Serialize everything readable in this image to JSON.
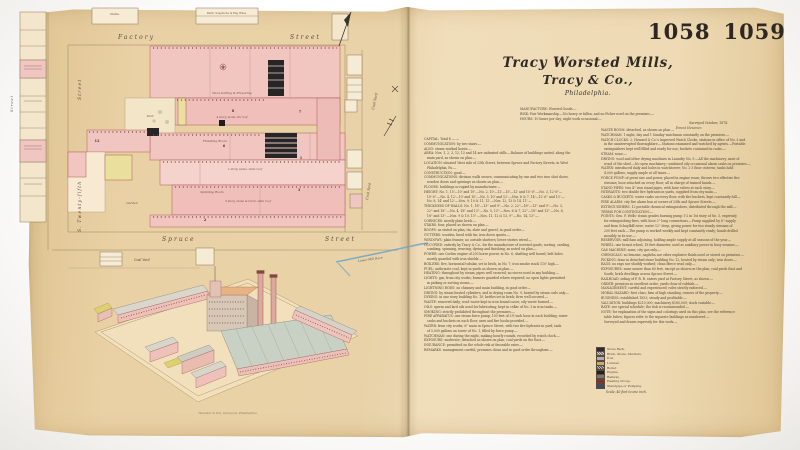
{
  "page": {
    "plate_left": "1058",
    "plate_right": "1059"
  },
  "title": {
    "line1": "Tracy Worsted Mills,",
    "line2": "Tracy & Co.,",
    "line3": "Philadelphia."
  },
  "header": {
    "line1": "MANUFACTURE: Worsted Goods.—",
    "line2": "RISK: Fair Workmanship.—No heavy or fallen, and no Picker used on the premises.—",
    "line3": "HOURS: 10 hours per day; night work occasional.—",
    "surveyed": "Surveyed October, 1874.",
    "signature": "Ernest Hexamer."
  },
  "notes": {
    "col1": [
      "CAPITAL: Total $ —.—",
      "COMMUNICATION: by two stairs.—",
      "ALSO: steam worked hoists.—",
      "AREA: Nos. 1, 2, 3, 12, 13 and 14 are unheated stills.—Balance of buildings united, along the",
      "   main yard, as shown on plan.—",
      "LOCATION: situated West side of 25th Street, between Spruce and Factory Streets, in West",
      "   Philadelphia, Pa.—",
      "CONSTRUCTION: good.—",
      "COMMUNICATIONS: division walls secure, communicating by one and two iron shut doors,",
      "   wooden doors and openings as shown on plan.—",
      "FLOORS: buildings occupied by manufacturer.—",
      "HEIGHT: No. 1, 15'—10' and 10'.—No. 2, 10'—12'—15'—12' and 10' 6''.—No. 3, 12' 6''—",
      "   10' 6''.—No. 4, 12'—10' and 10'.—No. 5, 10' and 12'.—Nos. 6 & 7, 14'—12' 6'' and 13'.—",
      "   No. 8, 14' and 12'.—Nos. 9, 10 & 11, 12'.—Nos. 12, 13 & 14, 11'.—",
      "THICKNESS OF WALLS: No. 1, 18''—13'' and 9''.—No. 2, 22''—18''—13'' and 9''.—No. 3,",
      "   22'' and 18''.—No. 4, 18'' and 13''.—No. 5, 13''.—Nos. 6 & 7, 22''—18'' and 13''.—No. 8,",
      "   18'' and 13''.—Nos. 9 & 10, 13''.—Nos. 11, 12 & 13, 9''.—No. 14, 13''.—",
      "CORNICES: mostly plain brick.—",
      "STAIRS: four, placed as shown on plan.—",
      "ROOFS: as stated on plan; tin, slate and gravel, in good order.—",
      "GUTTERS: wooden, lined with tin; iron down spouts.—",
      "WINDOWS: plain frames; no outside shutters; lower stories wired.—",
      "OCCUPIED: entirely by Tracy & Co., for the manufacture of worsted goods; sorting, carding,",
      "   combing, spinning, weaving, dyeing and finishing, as noted on plan.—",
      "POWER: one Corliss engine of 250 horse power, in No. 6; shafting well boxed; belt holes",
      "   mostly guarded with iron shields.—",
      "BOILERS: five, horizontal tubular, set in brick, in No. 7; iron smoke stack 110' high.—",
      "FUEL: anthracite coal, kept in yards as shown on plan.—",
      "HEATING: throughout by steam; pipes well secured; no stoves used in any building.—",
      "LIGHTS: gas, from city works; burners guarded where required; no open lights permitted",
      "   in picking or sorting rooms.—",
      "LIGHTNING RODS: on chimney and main building, in good order.—",
      "DRYING: by steam heated cylinders, and in drying room No. 9, heated by steam coils only.—",
      "DYEING: in one story building No. 10; kettles set in brick; fires well secured.—",
      "WASTE: removed daily; wool waste kept in iron bound cases; oily waste burned.—",
      "OILS: sperm and lard oils used for lubricating; kept in cellar of No. 3 in iron tanks.—",
      "SMOKING: strictly prohibited throughout the premises.—",
      "FIRE APPARATUS: one steam force pump; 150 feet of 2½ inch hose in each building; water",
      "   casks and buckets on each floor; axes and fire hooks provided.—",
      "WATER: from city works; 6'' main in Spruce Street, with two fire hydrants in yard; tank",
      "   of 5,000 gallons on tower of No. 1, filled by force pump.—",
      "WATCHMAN: one during the night, making hourly rounds, recorded by watch clock.—",
      "EXPOSURE: moderate; detached as shown on plan; coal yards on the East.—",
      "INSURANCE: permitted on the whole risk at favorable rates.—",
      "REMARKS: management careful; premises clean and in good order throughout.—"
    ],
    "col2": [
      "WASTE ROOM: detached, as shown on plan.—",
      "WATCHMAN: 1 night, day and 1 Sunday watchman constantly on the premises.—",
      "WATCH CLOCKS: 2, Howard & Co.'s Improved Watch Clocks; stations in office of No. 3 and",
      "   in the uninterrupted thoroughfare.—Stations examined and watched by agents.—Portable",
      "   extinguishers kept well filled and ready for use; buckets contained in racks.—",
      "STEAM: none.—",
      "DRYING: wool and other drying machines in Laundry No. 9.—All the machinery, most of",
      "   wood of the shed.—No open machinery; combined oily occasional alarm casks on premises.—",
      "WATER: introduced daily and holes in watchtower; No. 2-3 floor cisterns; tanks hold",
      "   4,000 gallons; supply ample at all times.—",
      "FORCE PUMP: of great size and power, placed in engine room; throws two effective fire",
      "   streams; hose attached on every floor; all in charge of trained hands.—",
      "STAND PIPES: two 4'' iron stand pipes, with hose valves at each story.—",
      "HYDRANTS: two double fire hydrants in yards, supplied from city main.—",
      "CASKS & BUCKETS: water casks on every floor, with fire buckets, kept constantly full.—",
      "FIRE ALARM: city fire alarm box at corner of 25th and Spruce Streets.—",
      "EXTINGUISHERS: 12 portable chemical extinguishers, distributed through the mill.—",
      "TERMS FOR CONTINUATION:—",
      "POINTS: Gen. F. Wells' steam grades burning pump 1-2 in 1st story of No. 3, expressly",
      "   for extinguishing fires, with hose 2'' long connections.—Pump supplied by 6'' supply",
      "   and from Schuylkill river; water 12'' deep, giving power for two steady streams of",
      "   200 feet each.—The pump is worked weekly and kept constantly ready; hands drilled",
      "   monthly in its use.—",
      "RESERVOIR: mill dam adjoining, holding ample supply at all seasons of the year.—",
      "WHEEL: one breast wheel, 18 feet diameter, used as auxiliary power in busy seasons.—",
      "GAS MACHINE: none; city gas only.—",
      "CHEMICALS: no benzine, naphtha nor other explosive fluids used or stored on premises.—",
      "PICKING: done in detached stone building No. 12, heated by steam only; iron doors.—",
      "RAGS: no rags nor shoddy worked; clean fleece wool only.—",
      "EXPOSURES: none nearer than 60 feet, except as shown on the plan; coal yards East and",
      "   South; brick dwellings across Spruce Street.—",
      "RAILROAD: siding of P. R. R. enters yard at Factory Street, as shown.—",
      "ORDER: premises in excellent order; yards clear of rubbish.—",
      "MANAGEMENT: careful and experienced; rules strictly enforced.—",
      "MORAL HAZARD: first class; firm of high standing, owners of the property.—",
      "BUSINESS: established 1853; steady and profitable.—",
      "VALUATION: buildings $210,000; machinery $185,000; stock variable.—",
      "RATE: see special schedule; the risk is recommended.—",
      "NOTE: for explanation of the signs and colorings used on this plan, see the reference",
      "   table below; figures refer to the separate buildings as numbered.—",
      "   Surveyed and drawn expressly for this work.—"
    ]
  },
  "legend": {
    "rows": [
      {
        "color": "#2a2a3c",
        "label": "Stone Back."
      },
      {
        "color": "#6b6b6b",
        "hatch": true,
        "label": "Brick, Stone, Shutters."
      },
      {
        "color": "#b0b0b0",
        "label": "Iron."
      },
      {
        "color": "#c9a96e",
        "label": "Lumber."
      },
      {
        "color": "#444444",
        "hatch": true,
        "label": "Boiler."
      },
      {
        "color": "#222222",
        "label": "Engine."
      },
      {
        "color": "#777777",
        "label": "Railway."
      },
      {
        "color": "#8a2f28",
        "label": "Heating Group."
      },
      {
        "color": "#30507a",
        "label": "Standpipe or Pumping."
      }
    ],
    "footer": "Scale, 40 feet to one inch."
  },
  "map": {
    "streets": {
      "factory": "Factory",
      "street_top": "Street",
      "spruce": "Spruce",
      "street_bottom": "Street",
      "left_lower": "S. Twenty-fifth",
      "left_upper": "Street",
      "far_left": "Street"
    },
    "labels": {
      "coal_yard_1": "Coal Yard",
      "coal_yard_2": "Coal Yard",
      "coal_yard_3": "Coal Yard",
      "creek": "Lower Mill Race",
      "wool": "Wool Sorting & Preparing",
      "story4": "4 story, stone, tin roof",
      "finishing": "Finishing Room",
      "story1": "1 story, stone, slate roof",
      "spinning": "Spinning Room",
      "story3": "3 story, stone & brick, slate roof",
      "yard": "Yard",
      "garden": "Garden",
      "stable": "Stable.",
      "warehouse": "Paint, Soapstone & Rag Whse."
    },
    "numbers": [
      "9",
      "8",
      "6",
      "12",
      "7",
      "1",
      "3",
      "2"
    ]
  },
  "birdseye": {
    "caption": "Hexamer & Son, Surveyors, Philadelphia."
  },
  "colors": {
    "paper": "#ecd7ae",
    "brick_pink": "#f2c6c0",
    "frame_yellow": "#ebdf9e",
    "ink": "#55493c",
    "water_blue": "#6fa7c4",
    "black_detail": "#262626"
  }
}
